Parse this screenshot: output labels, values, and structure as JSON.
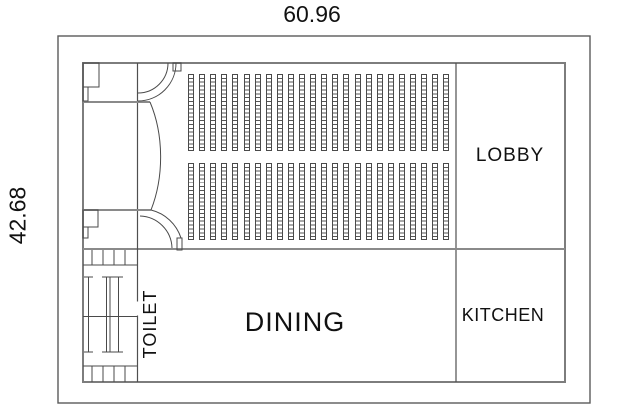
{
  "drawing": {
    "type": "floor-plan",
    "dimensions": {
      "top": "60.96",
      "left": "42.68"
    },
    "rooms": {
      "lobby": "LOBBY",
      "kitchen": "KITCHEN",
      "dining": "DINING",
      "toilet": "TOILET"
    },
    "seating": {
      "blocks": [
        {
          "x": 188,
          "y": 74,
          "height": 77
        },
        {
          "x": 188,
          "y": 163,
          "height": 77
        }
      ],
      "columns_per_block": 24,
      "column_width": 6,
      "column_pitch": 11.1,
      "cells_per_column": 20
    },
    "colors": {
      "background": "#ffffff",
      "line": "#4a4a4a",
      "wall": "#7d7d7d",
      "frame": "#5a5a5a",
      "text": "#111111"
    }
  }
}
